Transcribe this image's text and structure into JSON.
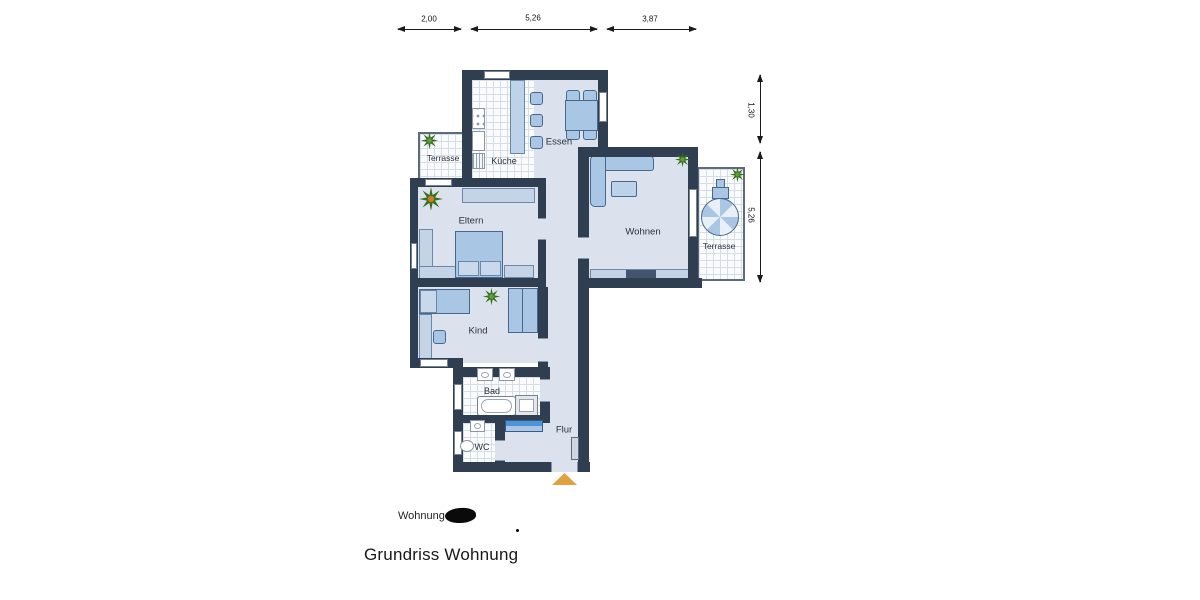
{
  "plan": {
    "rooms": {
      "terrace_left": "Terrasse",
      "kitchen": "Küche",
      "dining": "Essen",
      "parents": "Eltern",
      "living": "Wohnen",
      "terrace_right": "Terrasse",
      "child": "Kind",
      "bath": "Bad",
      "wc": "WC",
      "hall": "Flur"
    },
    "dimensions": {
      "top": [
        "2,00",
        "5,26",
        "3,87"
      ],
      "right": [
        "1,30",
        "5,26"
      ]
    },
    "icons": {
      "plant": "green starburst plant top-view",
      "parasol": "patio umbrella top-view",
      "entrance_marker": "orange triangle entrance arrow"
    },
    "colors": {
      "wall": "#2f3e50",
      "floor": "#dbe2ed",
      "furniture": "#a9c6e4",
      "furniture_light": "#c4d3e5",
      "accent_wardrobe": "#4e94d4",
      "plant": "#36701f",
      "entrance_arrow": "#e0a23e"
    }
  },
  "footer": {
    "apartment_label": "Wohnung Nr.",
    "caption": "Grundriss Wohnung"
  }
}
